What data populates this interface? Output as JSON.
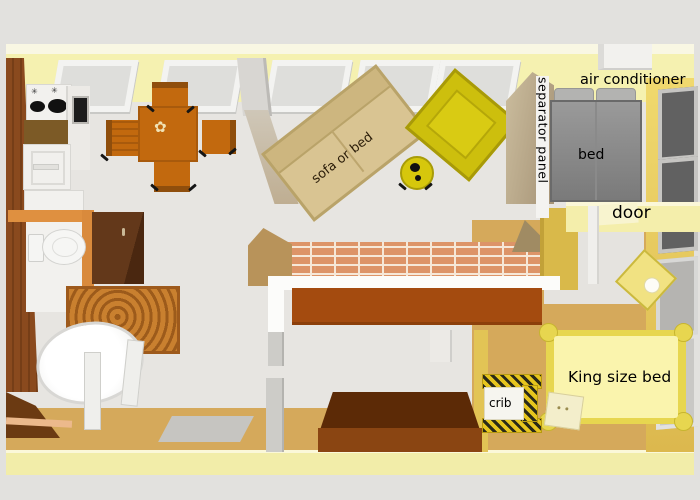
{
  "labels": {
    "sofa_or_bed": "sofa or bed",
    "air_conditioner": "air conditioner",
    "separator_panel": "separator panel",
    "bed": "bed",
    "door": "door",
    "king_size_bed": "King size bed",
    "crib": "crib"
  },
  "icons": {
    "stove_knob_glyph": "✳",
    "table_flower_glyph": "✿"
  },
  "colors": {
    "outside_gray": "#e2e1de",
    "interior_floor_gray": "#e7e5e1",
    "wall_yellow": "#f5f1b0",
    "wall_gold": "#d9b94a",
    "right_wall_yellow": "#e3c455",
    "floor_tan": "#d5a95b",
    "brick": "#dd9468",
    "wood_brown": "#8a4a1e",
    "counter_brown": "#a44b0f",
    "furniture_orange": "#c2690e",
    "sofa_beige": "#d9c492",
    "armchair_yellow": "#cdbf0d",
    "bed_gray": "#8f8f8f",
    "king_bed_yellow": "#faf4ad",
    "crib_yellow": "#e6c51e"
  }
}
